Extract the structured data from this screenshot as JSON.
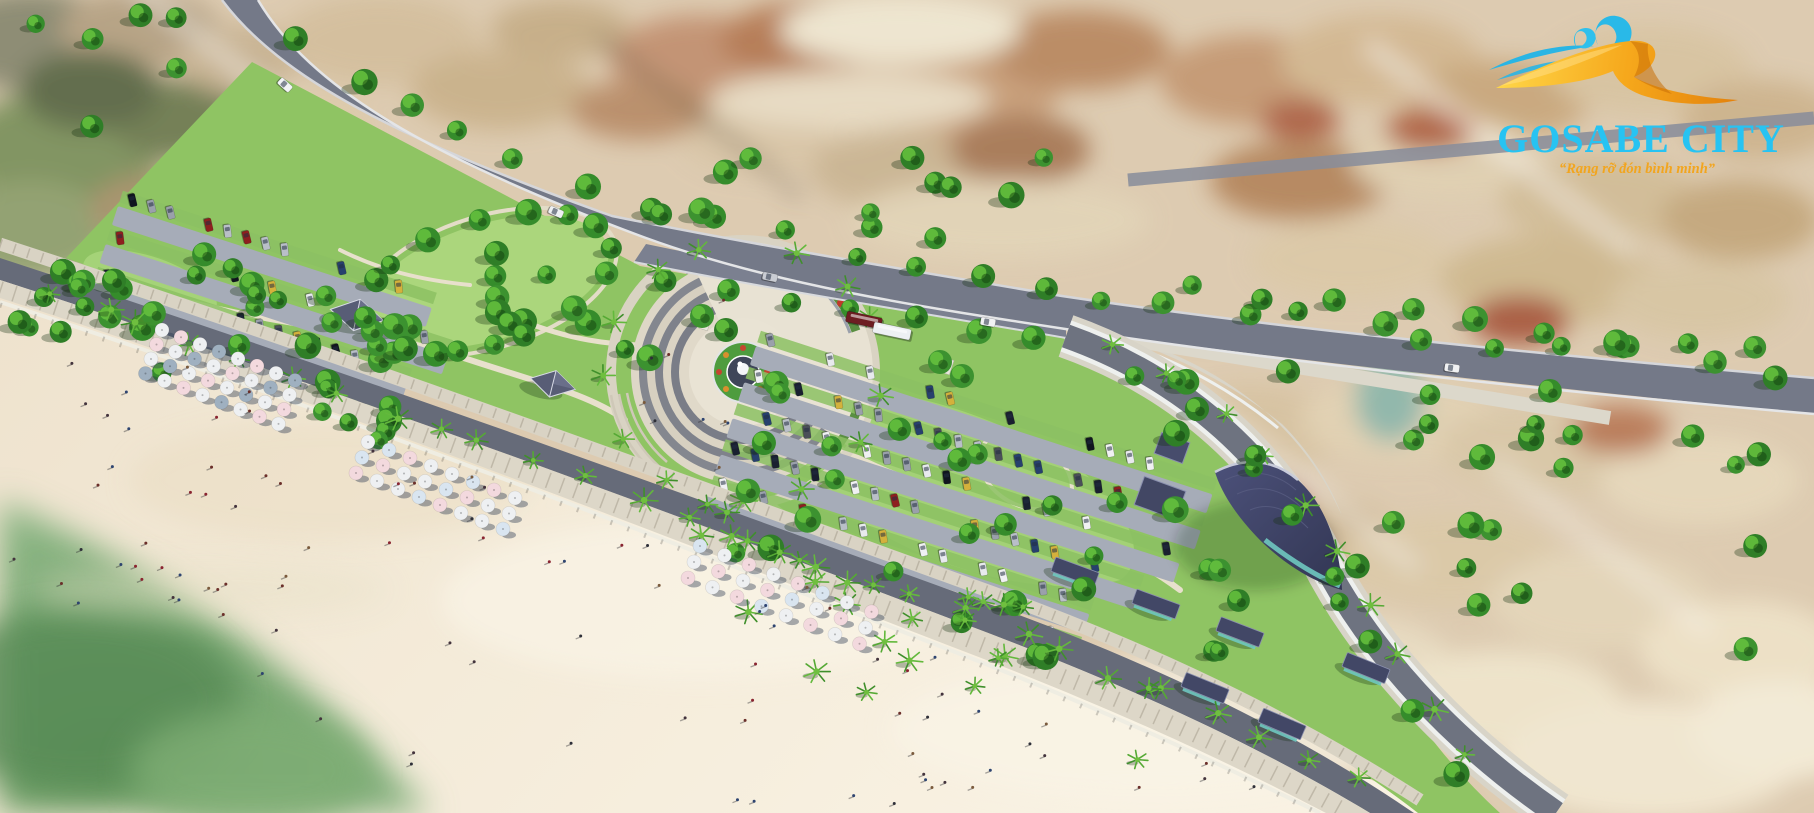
{
  "logo": {
    "title": "GOSABE CITY",
    "tagline": "“Rạng rỡ đón bình minh”"
  },
  "palette": {
    "logo_cyan": "#27c3f2",
    "logo_orange": "#f2a51e",
    "logo_gold_light": "#ffd84a",
    "logo_gold": "#f6a81c",
    "logo_gold_deep": "#e07c0a",
    "logo_wave": "#29b6e6",
    "ocean": "#85b083",
    "ocean_deep": "#5f9260",
    "sand": "#f3e9d6",
    "sand_light": "#f9f2e3",
    "town": "#ddcbb1",
    "road": "#717684",
    "road_dark": "#666b79",
    "curb": "#e8e9ea",
    "sidewalk": "#dbd5c6",
    "park": "#8fc463",
    "lawn": "#abd67c",
    "tree_dark": "#2f7e27",
    "tree_mid": "#3c9230",
    "tree_light": "#66c23e",
    "palm": "#4da32e",
    "plaza_light": "#e8e2d3",
    "plaza_step": "#7e828c",
    "roof_navy": "#424766",
    "glass_teal": "#6fc8c0",
    "parking": "#a6acb8",
    "stall_green": "#8cc163"
  },
  "scene": {
    "umbrella_colors": {
      "white": "#eef0f2",
      "pink": "#f3d9de",
      "blue": "#d9e5f0",
      "slate": "#9fb0c0"
    },
    "umbrella_clusters": [
      {
        "ox": 162,
        "oy": 330,
        "cols": 8,
        "rows": 4,
        "ux": 19,
        "uy": 7.2,
        "vx": -5.5,
        "vy": 14.5,
        "palette": [
          "white",
          "pink",
          "white",
          "slate"
        ]
      },
      {
        "ox": 368,
        "oy": 442,
        "cols": 8,
        "rows": 3,
        "ux": 21,
        "uy": 8,
        "vx": -6,
        "vy": 15.5,
        "palette": [
          "white",
          "blue",
          "pink",
          "white"
        ]
      },
      {
        "ox": 700,
        "oy": 546,
        "cols": 8,
        "rows": 3,
        "ux": 24.5,
        "uy": 9.4,
        "vx": -6,
        "vy": 16,
        "palette": [
          "blue",
          "white",
          "pink",
          "white",
          "pink"
        ]
      }
    ],
    "car_colors": [
      "#10151f",
      "#1a2030",
      "#f0f1f3",
      "#e8eaee",
      "#b9bfc8",
      "#9aa0ab",
      "#8e1f1f",
      "#27406e",
      "#4a4f58",
      "#d4b13c"
    ],
    "road_vehicles": {
      "cars": [
        {
          "x": 285,
          "y": 85,
          "rot": 42,
          "color": "#f2f3f5"
        },
        {
          "x": 556,
          "y": 212,
          "rot": 24,
          "color": "#eef0f2"
        },
        {
          "x": 770,
          "y": 277,
          "rot": 12,
          "color": "#c9ccd3"
        },
        {
          "x": 988,
          "y": 322,
          "rot": 10,
          "color": "#f1f2f4"
        },
        {
          "x": 1452,
          "y": 368,
          "rot": 8,
          "color": "#f0f1f3"
        }
      ],
      "buses": [
        {
          "x": 864,
          "y": 320,
          "rot": 12,
          "len": 36,
          "color": "#6d1d22"
        },
        {
          "x": 892,
          "y": 331,
          "rot": 12,
          "len": 38,
          "color": "#edf0f3"
        }
      ]
    },
    "beach_people_count": 85,
    "swimmer_count": 7,
    "plaza_people_count": 9,
    "tree_regions": [
      {
        "type": "line",
        "pts": [
          [
            260,
            30
          ],
          [
            430,
            140
          ],
          [
            640,
            235
          ],
          [
            1100,
            318
          ],
          [
            1800,
            396
          ]
        ],
        "off": -22,
        "count": 24,
        "jit": 10,
        "kind": "tree"
      },
      {
        "type": "line",
        "pts": [
          [
            640,
            262
          ],
          [
            1070,
            330
          ]
        ],
        "off": 16,
        "count": 7,
        "jit": 5,
        "kind": "tree"
      },
      {
        "type": "rect",
        "x": 60,
        "y": 185,
        "w": 430,
        "h": 150,
        "rot": 19,
        "count": 40,
        "kind": "tree"
      },
      {
        "type": "rect",
        "x": 480,
        "y": 238,
        "w": 200,
        "h": 75,
        "rot": 19,
        "count": 10,
        "kind": "tree"
      },
      {
        "type": "ring",
        "cx": 743,
        "cy": 372,
        "r": 140,
        "count": 13,
        "kind": "palm"
      },
      {
        "type": "rect",
        "x": 770,
        "y": 380,
        "w": 400,
        "h": 185,
        "rot": 17,
        "count": 24,
        "kind": "tree"
      },
      {
        "type": "rect",
        "x": 700,
        "y": 472,
        "w": 520,
        "h": 155,
        "rot": 19,
        "count": 24,
        "kind": "palm"
      },
      {
        "type": "rect",
        "x": 1170,
        "y": 340,
        "w": 600,
        "h": 330,
        "rot": 0,
        "count": 34,
        "kind": "tree"
      },
      {
        "type": "line",
        "pts": [
          [
            1080,
            348
          ],
          [
            1195,
            402
          ],
          [
            1280,
            490
          ],
          [
            1330,
            580
          ],
          [
            1400,
            690
          ],
          [
            1465,
            795
          ]
        ],
        "off": -16,
        "count": 10,
        "jit": 5,
        "kind": "palm"
      },
      {
        "type": "rect",
        "x": 10,
        "y": 15,
        "w": 200,
        "h": 125,
        "rot": 0,
        "count": 6,
        "kind": "tree"
      },
      {
        "type": "line",
        "pts": [
          [
            20,
            295
          ],
          [
            500,
            462
          ],
          [
            1000,
            642
          ],
          [
            1370,
            795
          ]
        ],
        "off": -13,
        "count": 28,
        "jit": 6,
        "kind": "palm"
      },
      {
        "type": "line",
        "pts": [
          [
            1160,
            300
          ],
          [
            1790,
            376
          ]
        ],
        "off": -20,
        "count": 9,
        "jit": 8,
        "kind": "tree"
      },
      {
        "type": "rect",
        "x": 660,
        "y": 120,
        "w": 400,
        "h": 120,
        "rot": 0,
        "count": 12,
        "kind": "tree"
      },
      {
        "type": "ering",
        "cx": 488,
        "cy": 282,
        "rx": 128,
        "ry": 62,
        "rot": -17,
        "count": 16,
        "kind": "tree"
      },
      {
        "type": "line",
        "pts": [
          [
            1110,
            330
          ],
          [
            1230,
            395
          ],
          [
            1310,
            480
          ],
          [
            1360,
            570
          ],
          [
            1430,
            680
          ],
          [
            1500,
            790
          ]
        ],
        "off": 28,
        "count": 8,
        "jit": 6,
        "kind": "tree"
      },
      {
        "type": "pts",
        "pts": [
          [
            702,
            316
          ],
          [
            726,
            330
          ],
          [
            940,
            362
          ],
          [
            962,
            376
          ]
        ],
        "r": 12,
        "kind": "tree"
      }
    ],
    "parking_lots": [
      {
        "cx": 118,
        "cy": 206,
        "rot": 18,
        "lane_ys": [
          0,
          40,
          80
        ],
        "lane_lens": [
          330,
          360,
          330
        ],
        "spacing": 20,
        "fill_ratio": 0.68
      },
      {
        "cx": 756,
        "cy": 346,
        "rot": 18,
        "lane_ys": [
          0,
          38,
          76,
          114,
          152
        ],
        "lane_lens": [
          480,
          480,
          470,
          440,
          400
        ],
        "spacing": 21,
        "fill_ratio": 0.6
      }
    ],
    "bungalows": [
      [
        1075,
        572,
        20
      ],
      [
        1156,
        604,
        20
      ],
      [
        1240,
        632,
        21
      ],
      [
        1205,
        688,
        22
      ],
      [
        1282,
        724,
        23
      ],
      [
        1366,
        668,
        22
      ]
    ],
    "pavilions": [
      [
        357,
        314,
        12,
        1
      ],
      [
        553,
        383,
        14,
        0.85
      ]
    ]
  }
}
